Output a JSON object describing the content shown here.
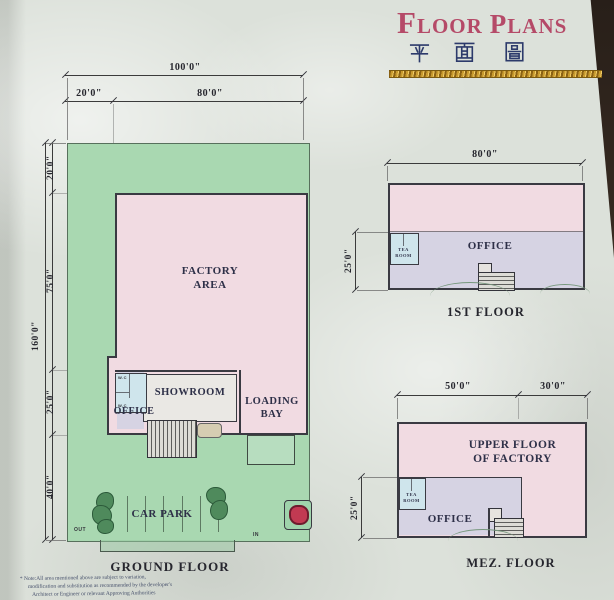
{
  "header": {
    "title_parts": [
      "F",
      "LOOR",
      "P",
      "LANS"
    ],
    "title_cjk": "平 面 圖"
  },
  "ground_floor": {
    "caption": "GROUND FLOOR",
    "dims": {
      "top_total": "100'0\"",
      "top_left": "20'0\"",
      "top_right": "80'0\"",
      "left_total": "160'0\"",
      "left_top": "20'0\"",
      "left_factory": "75'0\"",
      "left_office": "25'0\"",
      "left_carpark": "40'0\""
    },
    "rooms": {
      "factory": "FACTORY\nAREA",
      "showroom": "SHOWROOM",
      "loading_bay": "LOADING BAY",
      "office": "OFFICE",
      "wc": "W.C",
      "car_park": "CAR PARK"
    },
    "site_labels": {
      "out": "OUT",
      "in": "IN"
    }
  },
  "first_floor": {
    "caption": "1ST FLOOR",
    "dims": {
      "top": "80'0\"",
      "left": "25'0\""
    },
    "rooms": {
      "office": "OFFICE",
      "tea_room": "TEA\nROOM"
    }
  },
  "mez_floor": {
    "caption": "MEZ. FLOOR",
    "dims": {
      "top_left": "50'0\"",
      "top_right": "30'0\"",
      "left": "25'0\""
    },
    "rooms": {
      "upper_factory": "UPPER FLOOR\nOF FACTORY",
      "office": "OFFICE",
      "tea_room": "TEA\nROOM"
    }
  },
  "footnote": {
    "lines": [
      "* Note:All area mentioned above are subject to variation,",
      "modification and substitution as recommended by the developer's",
      "Architect or Engineer or relevant Approving Authorities"
    ]
  },
  "colors": {
    "accent-title": "#b54a68",
    "cjk-blue": "#2c3a6b",
    "gold": "#c89a2e",
    "paper": "#dce1da",
    "plot-green": "#a9d8b1",
    "tree-green": "#4f8a5c",
    "factory-pink": "#f1dbe2",
    "office-lavender": "#d6d3e3",
    "tea-blue": "#cfe5ec",
    "wall-dark": "#3a3a42",
    "red-marker": "#c23a52"
  }
}
